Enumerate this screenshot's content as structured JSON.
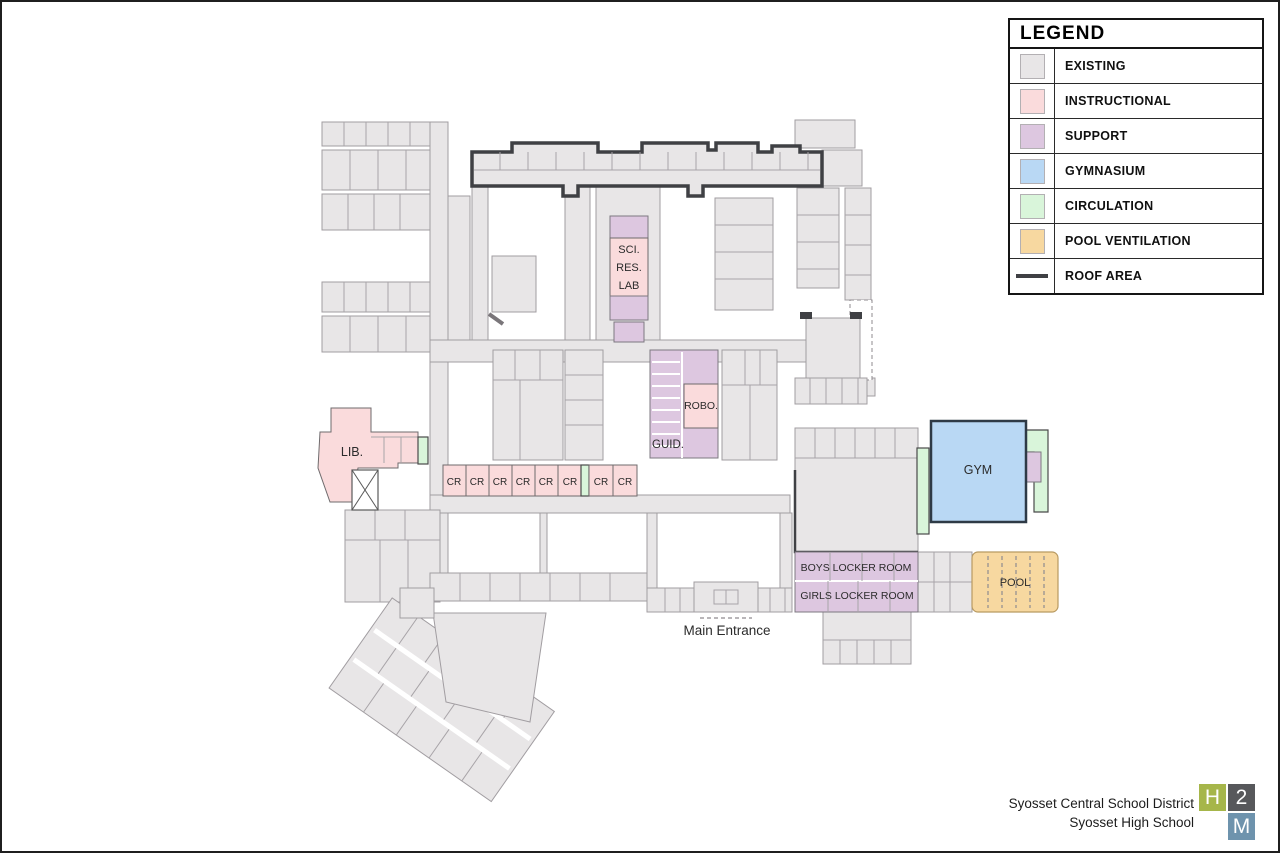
{
  "colors": {
    "existing": "#e8e6e7",
    "instructional": "#fadbdc",
    "support": "#ddc7e0",
    "gymnasium": "#b9d8f4",
    "circulation": "#d9f5da",
    "pool-ventilation": "#f7d8a0",
    "roof-line": "#3f4044",
    "logo-h": "#a6b64a",
    "logo-2": "#57585b",
    "logo-m": "#6e93ad"
  },
  "legend": {
    "title": "LEGEND",
    "items": [
      {
        "label": "EXISTING",
        "hex": "#e8e6e7"
      },
      {
        "label": "INSTRUCTIONAL",
        "hex": "#fadbdc"
      },
      {
        "label": "SUPPORT",
        "hex": "#ddc7e0"
      },
      {
        "label": "GYMNASIUM",
        "hex": "#b9d8f4"
      },
      {
        "label": "CIRCULATION",
        "hex": "#d9f5da"
      },
      {
        "label": "POOL VENTILATION",
        "hex": "#f7d8a0"
      },
      {
        "label": "ROOF AREA",
        "hex": "#3f4044"
      }
    ]
  },
  "plan": {
    "labels": {
      "sci_res_lab": [
        "SCI.",
        "RES.",
        "LAB"
      ],
      "robo": "ROBO.",
      "guid": "GUID.",
      "lib": "LIB.",
      "gym": "GYM",
      "pool": "POOL",
      "boys_locker": "BOYS LOCKER ROOM",
      "girls_locker": "GIRLS LOCKER ROOM",
      "main_entrance": "Main Entrance",
      "cr": [
        "CR",
        "CR",
        "CR",
        "CR",
        "CR",
        "CR",
        "CR",
        "CR"
      ]
    }
  },
  "footer": {
    "district": "Syosset Central School District",
    "school": "Syosset High School",
    "logo": {
      "h": "H",
      "two": "2",
      "m": "M"
    }
  }
}
